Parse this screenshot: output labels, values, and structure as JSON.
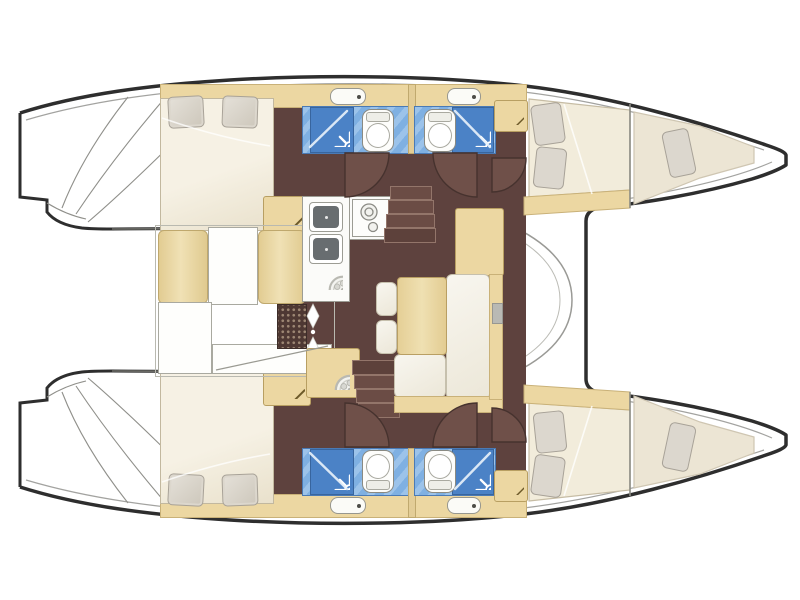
{
  "meta": {
    "title": "Catamaran interior layout plan (top view)",
    "diagram_type": "yacht-floor-plan",
    "orientation": "bows-to-the-right, sterns-to-the-left",
    "visible_text": []
  },
  "palette": {
    "background": "#ffffff",
    "hull_outline": "#2e2e2e",
    "thin_deck_lines": "#9a9a9a",
    "floor_maroon": "#5e423e",
    "floor_dark": "#503a35",
    "door_leaf": "#6f5049",
    "wood_tan": "#ecd7a2",
    "bed_cream": "#f3eedd",
    "pillow_grey": "#d9d4cb",
    "shower_blue": "#7fb0e2",
    "shower_stall_blue": "#4b82c6",
    "fixture_white": "#fdfdfb"
  },
  "vessel": {
    "type": "sailing catamaran",
    "cabins": 4,
    "bathrooms": 4,
    "forepeak_berths": 2,
    "port_hull": {
      "aft_cabin": {
        "fixtures": [
          "double-bed",
          "pillow",
          "pillow",
          "wardrobe-hanger-icon"
        ]
      },
      "bathroom_aft": {
        "fixtures": [
          "shower-stall",
          "shower-spray-icon",
          "toilet",
          "sink"
        ]
      },
      "bathroom_fwd": {
        "fixtures": [
          "shower-stall",
          "shower-spray-icon",
          "toilet",
          "sink",
          "wardrobe-hanger-icon"
        ]
      },
      "forward_cabin": {
        "fixtures": [
          "double-bed",
          "pillow",
          "pillow"
        ]
      },
      "forepeak": {
        "fixtures": [
          "single-berth",
          "pillow"
        ]
      }
    },
    "starboard_hull": {
      "aft_cabin": {
        "fixtures": [
          "double-bed",
          "pillow",
          "pillow",
          "wardrobe-hanger-icon"
        ]
      },
      "bathroom_aft": {
        "fixtures": [
          "shower-stall",
          "shower-spray-icon",
          "toilet",
          "sink"
        ]
      },
      "bathroom_fwd": {
        "fixtures": [
          "shower-stall",
          "shower-spray-icon",
          "toilet",
          "sink",
          "wardrobe-hanger-icon"
        ]
      },
      "forward_cabin": {
        "fixtures": [
          "double-bed",
          "pillow",
          "pillow"
        ]
      },
      "forepeak": {
        "fixtures": [
          "single-berth",
          "pillow"
        ]
      }
    },
    "salon": {
      "fixtures": [
        "galley-counter",
        "double-sink",
        "four-burner-stove",
        "round-hatch",
        "round-hatch",
        "dining-table",
        "l-shaped-sofa",
        "seat-cushions",
        "companionway-steps-port",
        "companionway-steps-starboard",
        "entry-grid-mat",
        "entry-arrows"
      ]
    },
    "cockpit": {
      "fixtures": [
        "bench-cushion",
        "bench-cushion",
        "cockpit-table",
        "aft-bench"
      ]
    },
    "doors": [
      "bathroom-door-arc x4",
      "corridor-door-arc x2"
    ]
  }
}
